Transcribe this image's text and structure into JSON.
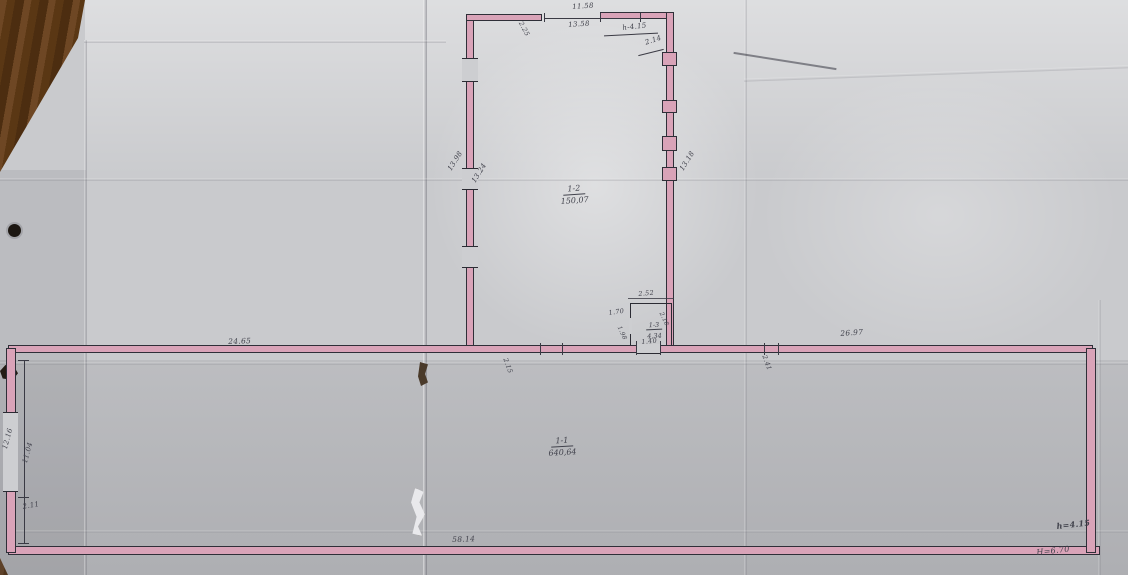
{
  "colors": {
    "wall_pink": "#d9a3b8",
    "wall_outline": "#2f2f38",
    "ink": "#41424c",
    "paper": "#c9cacd",
    "wood_table": "#5a3714"
  },
  "rooms": {
    "hall": {
      "number": "1-1",
      "area": "640,64"
    },
    "upper": {
      "number": "1-2",
      "area": "150,07"
    },
    "small": {
      "number": "1-3",
      "area": "4,34"
    }
  },
  "dimensions": {
    "top_width_inner": "11.58",
    "top_width_outer": "13.58",
    "top_right_note": "h-4.15",
    "top_right_small": "2.14",
    "top_left_small": "2.25",
    "upper_room_left_outer": "13.98",
    "upper_room_left_inner": "13.24",
    "upper_room_right": "13.18",
    "small_room_top": "2.52",
    "small_room_left": "1.70",
    "small_room_bottom": "1.40",
    "small_room_inner_small": "1.98",
    "small_room_right_small": "2.18",
    "hall_top_left": "24.65",
    "hall_top_right": "26.97",
    "hall_opening_left": "2.15",
    "hall_opening_right": "2.41",
    "hall_bottom": "58.14",
    "hall_left_upper": "12.16",
    "hall_left_lower": "11.04",
    "hall_left_bottom": "2.11"
  },
  "heights": {
    "inner_note": "h=4.15",
    "outer_note": "H=6.70"
  }
}
